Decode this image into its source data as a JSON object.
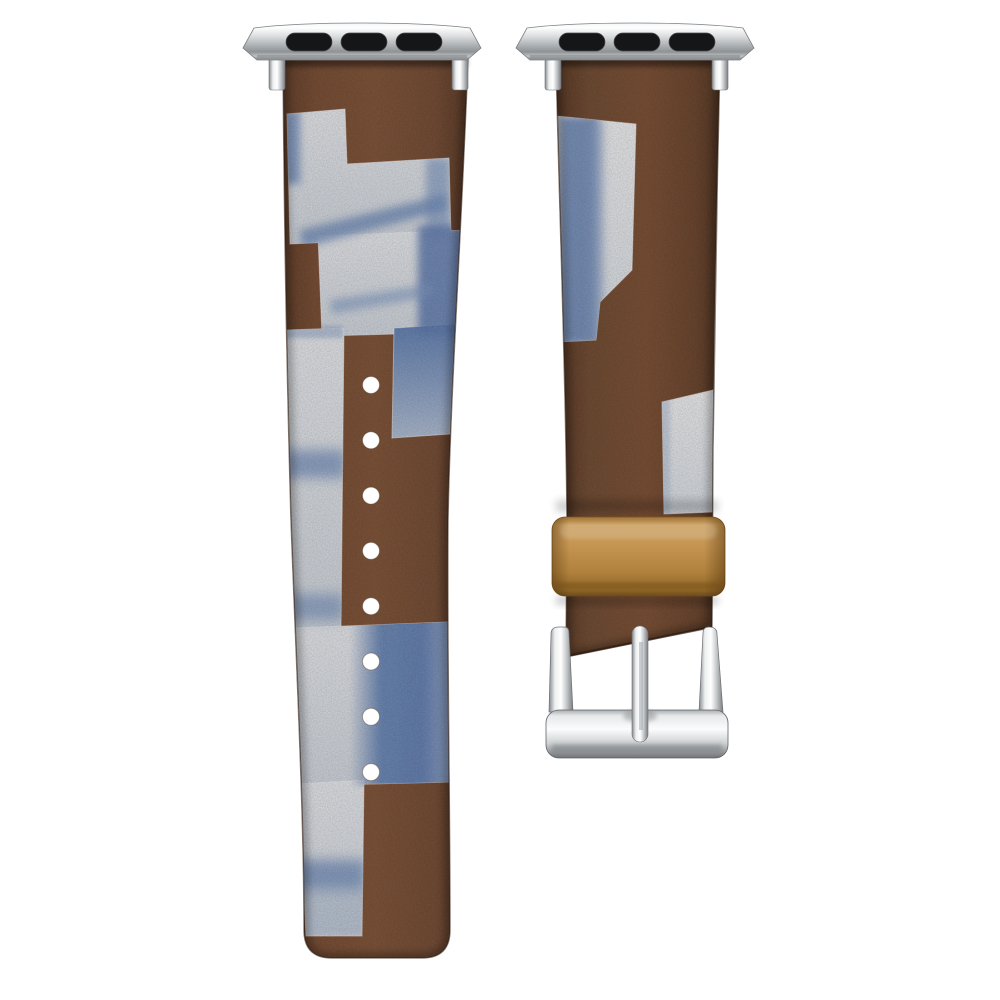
{
  "scene": {
    "type": "product-photo",
    "subject": "Two-piece fabric watch band with silver lug adapters, patchwork indigo canvas patches on brown fabric, tan keeper loop and silver pin buckle",
    "background": "#ffffff"
  },
  "colors": {
    "background": "#ffffff",
    "strap_brown": "#6b422a",
    "strap_brown_dark": "#4d2e1c",
    "strap_brown_light": "#72482e",
    "canvas_light": "#d3dbe3",
    "canvas_white": "#e8ebef",
    "indigo_strong": "#4d6ea8",
    "indigo_mid": "#7d97c0",
    "keeper_tan": "#b5813d",
    "keeper_tan_light": "#c89a57",
    "keeper_tan_dark": "#7a5520",
    "metal_light": "#fafbfb",
    "metal_mid": "#b9bcbf",
    "metal_dark": "#75797c",
    "slot_black": "#141618",
    "hole_white": "#ffffff"
  },
  "left_strap": {
    "role": "tail strap with adjustment holes",
    "hole_count": 8,
    "patch_count": 6
  },
  "right_strap": {
    "role": "buckle strap",
    "patch_count": 2,
    "hardware": [
      "lug adapter",
      "keeper loop",
      "pin buckle",
      "prong"
    ]
  },
  "adapters": {
    "count": 2,
    "slot_count_each": 3,
    "finish": "polished silver"
  }
}
